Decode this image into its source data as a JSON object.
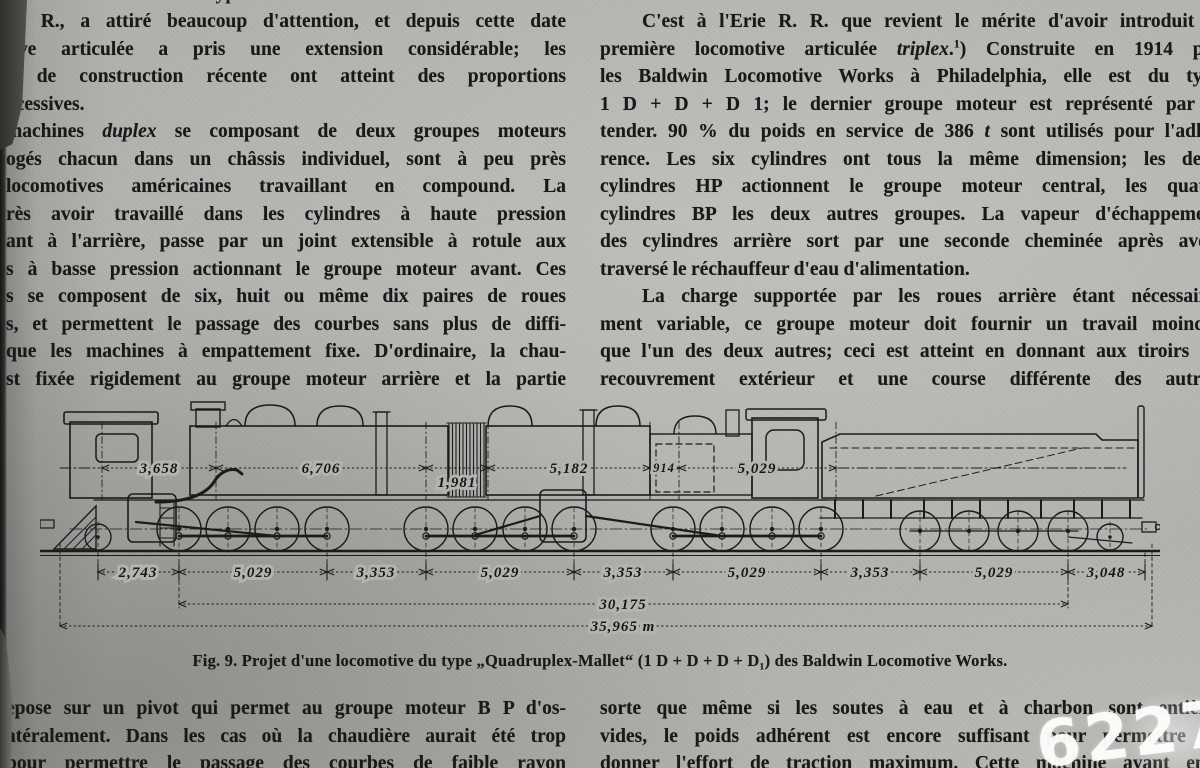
{
  "columns": {
    "top_left_partial": "Cette machine du type",
    "top_left": [
      "R. R., a attiré beaucoup d'attention, et depuis cette date",
      "tive articulée a pris une extension considérable; les",
      "s de construction récente ont atteint des proportions",
      "xcessives.",
      "machines <i>duplex</i> se composant de deux groupes moteurs",
      "ogés chacun dans un châssis individuel, sont à peu près",
      "locomotives américaines travaillant en compound.  La",
      "rès avoir travaillé dans les cylindres à haute pression",
      "ant à l'arrière, passe par un joint extensible à rotule aux",
      "s à basse pression actionnant le groupe moteur avant. Ces",
      "s se composent de six, huit ou même dix paires de roues",
      "s, et permettent le passage des courbes sans plus de diffi-",
      "que les machines à empattement fixe.  D'ordinaire, la chau-",
      "st fixée rigidement au groupe moteur arrière  et la partie"
    ],
    "top_right": [
      "C'est à l'Erie R. R. que revient le mérite d'avoir introduit la",
      "première locomotive articulée <i>triplex</i>.<sup>1</sup>) Construite en 1914 par",
      "les Baldwin Locomotive Works à Philadelphia, elle est du type",
      "1 D + D + D 1; le dernier groupe moteur est représenté par le",
      "tender.  90 % du poids en service de 386 <i>t</i> sont utilisés pour l'adhé-",
      "rence.  Les six cylindres ont tous la même dimension; les deux",
      "cylindres HP actionnent le groupe moteur central, les quatre",
      "cylindres BP les deux autres groupes.  La vapeur d'échappement",
      "des cylindres arrière sort par une seconde cheminée après avoir",
      "traversé le réchauffeur d'eau d'alimentation.",
      "La charge supportée par les roues arrière  étant nécessaire-",
      "ment variable, ce groupe moteur doit fournir un travail moindre",
      "que l'un des deux autres; ceci est atteint en donnant aux tiroirs un",
      "recouvrement extérieur et une course différente des autres,"
    ],
    "bottom_left": [
      "epose sur un pivot qui permet au groupe moteur B P d'os-",
      "atéralement.  Dans les cas où la chaudière aurait été trop",
      "pour permettre le passage des courbes de faible rayon"
    ],
    "bottom_right": [
      "sorte que même si les soutes à eau et à charbon sont entière-",
      "vides, le poids adhérent est encore suffisant pour permettre de",
      "donner l'effort de traction maximum.  Cette machine ayant emp"
    ]
  },
  "figure": {
    "caption": "Fig. 9.  Projet d'une locomotive du type „Quadruplex-Mallet“ (1 D + D + D + D₁) des Baldwin Locomotive Works.",
    "top_dims": [
      "3,658",
      "6,706",
      "1,981",
      "5,182",
      "914",
      "5,029"
    ],
    "bottom_dims": [
      "2,743",
      "5,029",
      "3,353",
      "5,029",
      "3,353",
      "5,029",
      "3,353",
      "5,029",
      "3,048"
    ],
    "total_1": "30,175",
    "total_2": "35,965 m"
  },
  "watermark": "6227"
}
